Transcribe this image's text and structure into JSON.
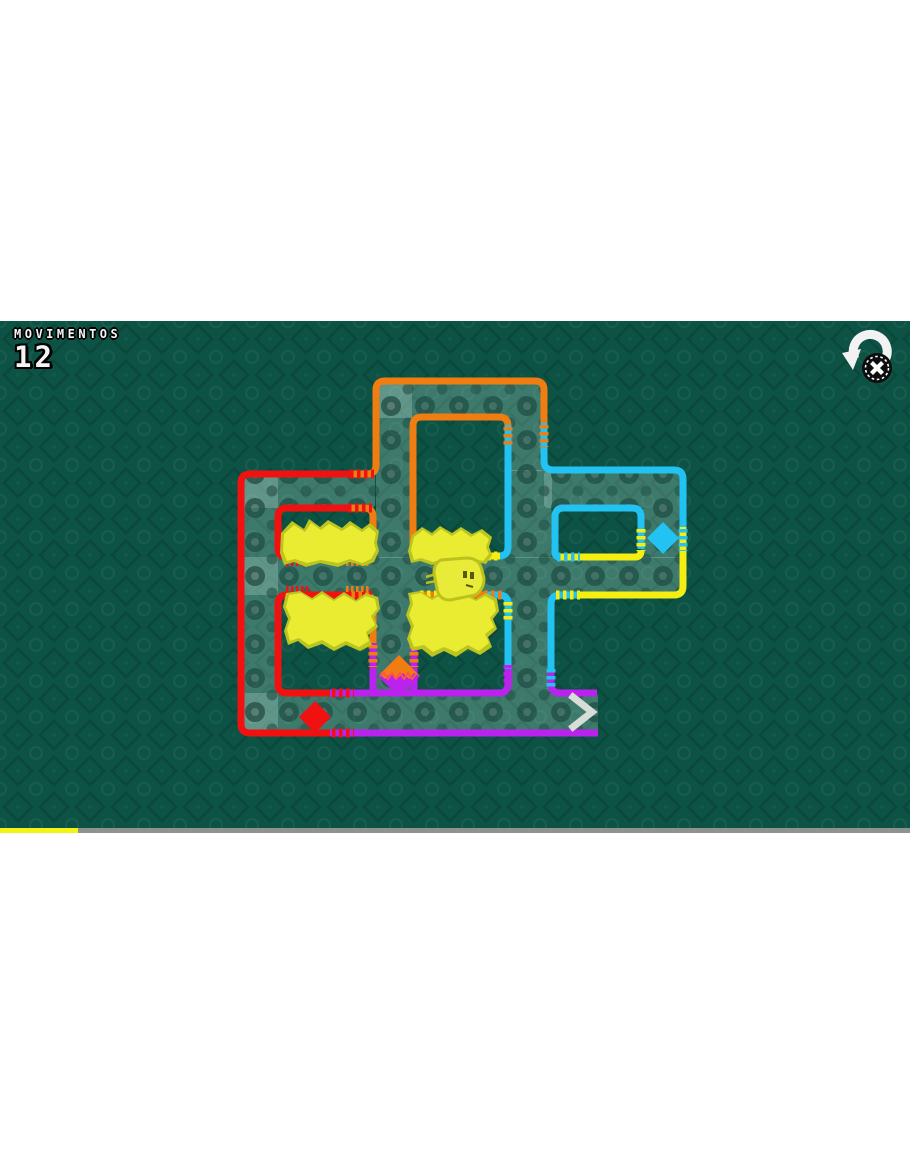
{
  "hud": {
    "moves_label": "MOVIMENTOS",
    "moves_count": "12",
    "restart_icon": "undo-circular-arrow",
    "restart_button_glyph": "X"
  },
  "level": {
    "moves_shown": 12,
    "painted_color_name": "yellow",
    "gates": [
      {
        "name": "red-gate-diamond",
        "color": "#f21111"
      },
      {
        "name": "cyan-gate-diamond",
        "color": "#22c3f2"
      },
      {
        "name": "split-gate-diamond",
        "colors": [
          "#f07d12",
          "#bb22ee"
        ]
      }
    ],
    "exit": {
      "name": "exit-chevron",
      "direction": "right",
      "color": "#d7ded8"
    },
    "player": {
      "name": "yellow-blob",
      "color": "#e8eb38"
    }
  },
  "palette": {
    "background": "#0d5345",
    "road_overlay": "rgba(198,230,220,0.26)",
    "wire_red": "#f21111",
    "wire_orange": "#f07d12",
    "wire_cyan": "#22c3f2",
    "wire_yellow": "#f5ee11",
    "wire_purple": "#bb22ee",
    "paint_yellow": "#e9ec31",
    "hud_text": "#f4f4f4"
  },
  "progress_bar": {
    "width_px": 78,
    "track_color": "#8e938f",
    "fill_color": "#f4f414"
  }
}
